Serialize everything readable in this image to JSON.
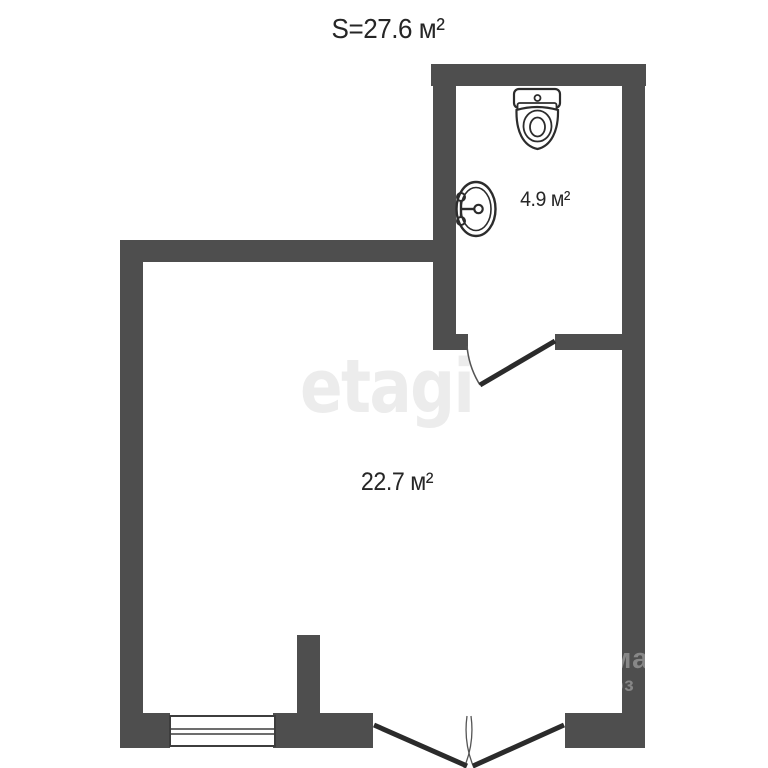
{
  "title": {
    "total_area_label": "S=27.6 м²"
  },
  "rooms": {
    "bathroom": {
      "area_label": "4.9 м²"
    },
    "living_room": {
      "area_label": "22.7 м²"
    }
  },
  "watermark": {
    "brand": "etagi",
    "wall_fragment_top": "ма",
    "wall_fragment_bottom": "эз"
  },
  "colors": {
    "wall": "#4e4e4e",
    "line": "#2b2b2b",
    "thinline": "#555555",
    "text": "#262626",
    "watermark": "#ececec",
    "background": "#ffffff"
  }
}
